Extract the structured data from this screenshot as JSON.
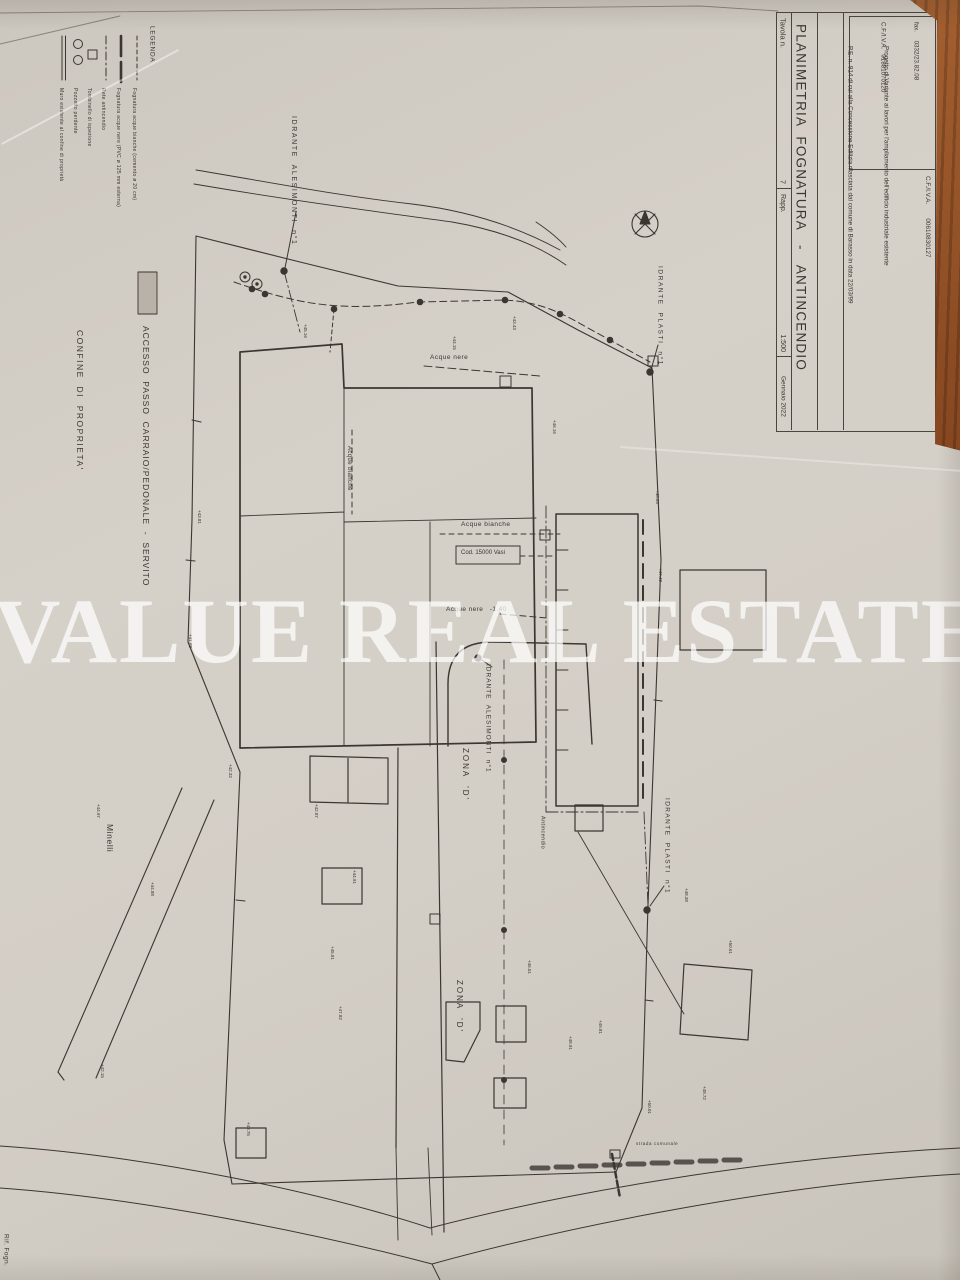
{
  "colors": {
    "paper": "#d3cec6",
    "ink": "#3b3631",
    "wood": "#8a4a22",
    "watermark": "rgba(255,255,255,0.72)",
    "access_swatch": "#b8b2a8"
  },
  "watermark": "VALUE REAL ESTATE",
  "title_block": {
    "tavola_label": "Tavola n.",
    "tavola_number": "7",
    "title": "PLANIMETRIA  FOGNATURA   -   ANTINCENDIO",
    "scale_label": "Rapp.",
    "scale_value": "1:500",
    "date": "Gennaio 2022",
    "project_line1": "Progetto di Variante ai lavori per l'ampliamento dell'edificio industriale esistente",
    "project_line2": "P.E. n. 914 di cui alla Concessione Edilizia rilasciata dal comune di Barasso in data 22/03/99",
    "engineer": {
      "name": "Ing.  Giuseppe  Ambrosetti",
      "address": "via  Robbioni  N. 17  Varese",
      "tel": "tel.      0332/28.51.85",
      "fax": "fax.     0332/23.82.08",
      "cf": "C.F./I.V.A.   01881070120"
    },
    "client": {
      "line1": "Committ.:  Ditta MONTI & C.   con sede in BARASSO",
      "line2": "BARASSO (Va) via Oltrona  n.  28.",
      "line3": "C.F./I.V.A.        00610830127"
    }
  },
  "legend": {
    "title": "LEGENDA",
    "items": [
      {
        "label": "Fognatura acque bianche (cemento ø 20 cm)",
        "x": 134
      },
      {
        "label": "Fognatura acque nere (PVC ø 125 mm esterna)",
        "x": 118
      },
      {
        "label": "Rete antincendio",
        "x": 103
      },
      {
        "label": "Tombinello di ispezione",
        "x": 89
      },
      {
        "label": "Pozzetto perdente",
        "x": 75
      },
      {
        "label": "Muro esistente al confine di proprietà",
        "x": 61
      }
    ],
    "access_label": "ACCESSO  PASSO  CARRAIO/PEDONALE  -  SERVITO",
    "boundary_label": "CONFINE  DI  PROPRIETA'"
  },
  "plan_labels": [
    {
      "name": "label-idrante-alesimonti-1",
      "text": "IDRANTE  ALESIMONTI  n°1",
      "x": 289,
      "y": 116,
      "w": 190,
      "fs": 7,
      "ls": 1.6,
      "o": "v"
    },
    {
      "name": "label-idrante-plasti-1",
      "text": "IDRANTE  PLASTI  n°1",
      "x": 656,
      "y": 266,
      "w": 150,
      "fs": 6.5,
      "ls": 1.6,
      "o": "v"
    },
    {
      "name": "label-idrante-alesimonti-2",
      "text": "IDRANTE  ALESIMONTI  n°1",
      "x": 484,
      "y": 664,
      "w": 165,
      "fs": 6.5,
      "ls": 1,
      "o": "v"
    },
    {
      "name": "label-idrante-plasti-2",
      "text": "IDRANTE  PLASTI  n°1",
      "x": 663,
      "y": 798,
      "w": 145,
      "fs": 6.5,
      "ls": 1.4,
      "o": "v"
    },
    {
      "name": "label-acque-nere-top",
      "text": "Acque nere",
      "x": 430,
      "y": 354,
      "w": 70,
      "fs": 6.5,
      "ls": 0.5,
      "o": "h"
    },
    {
      "name": "label-acque-bianche-vert",
      "text": "Acque bianche",
      "x": 345,
      "y": 446,
      "w": 80,
      "fs": 6,
      "ls": 0.4,
      "o": "v"
    },
    {
      "name": "label-acque-bianche-horiz",
      "text": "Acque bianche",
      "x": 461,
      "y": 521,
      "w": 84,
      "fs": 6.5,
      "ls": 0.5,
      "o": "h"
    },
    {
      "name": "label-cod-vasi",
      "text": "Cod. 15000 Vasi",
      "x": 461,
      "y": 550,
      "w": 58,
      "fs": 6,
      "ls": 0,
      "o": "h"
    },
    {
      "name": "label-acque-nere-quota",
      "text": "Acque nere   -1.40",
      "x": 446,
      "y": 606,
      "w": 110,
      "fs": 6.5,
      "ls": 0.4,
      "o": "h"
    },
    {
      "name": "label-zona-d-1",
      "text": "ZONA  'D'",
      "x": 461,
      "y": 748,
      "w": 64,
      "fs": 8,
      "ls": 2,
      "o": "v"
    },
    {
      "name": "label-zona-d-2",
      "text": "ZONA  'D'",
      "x": 455,
      "y": 980,
      "w": 64,
      "fs": 8,
      "ls": 2,
      "o": "v"
    },
    {
      "name": "label-minelli",
      "text": "Minelli",
      "x": 104,
      "y": 824,
      "w": 48,
      "fs": 8.5,
      "ls": 0.6,
      "o": "v"
    },
    {
      "name": "label-antincendio",
      "text": "Antincendio",
      "x": 539,
      "y": 816,
      "w": 66,
      "fs": 5.5,
      "ls": 0.4,
      "o": "v"
    },
    {
      "name": "label-strada-comunale",
      "text": "strada comunale",
      "x": 636,
      "y": 1141,
      "w": 70,
      "fs": 4.5,
      "ls": 0.6,
      "o": "h"
    },
    {
      "name": "label-rif-fognatura",
      "text": "Rif. Fogn.",
      "x": 2,
      "y": 1234,
      "w": 46,
      "fs": 6.5,
      "ls": 0.4,
      "o": "v"
    }
  ],
  "elevation_marks": [
    {
      "v": "+45.16",
      "x": 303,
      "y": 324
    },
    {
      "v": "+44.15",
      "x": 452,
      "y": 336
    },
    {
      "v": "+43.43",
      "x": 512,
      "y": 316
    },
    {
      "v": "+46.16",
      "x": 552,
      "y": 420
    },
    {
      "v": "+48.65",
      "x": 655,
      "y": 490
    },
    {
      "v": "+47.48",
      "x": 658,
      "y": 568
    },
    {
      "v": "+43.81",
      "x": 197,
      "y": 510
    },
    {
      "v": "+41.88",
      "x": 188,
      "y": 634
    },
    {
      "v": "+42.32",
      "x": 228,
      "y": 764
    },
    {
      "v": "+42.87",
      "x": 314,
      "y": 804
    },
    {
      "v": "+44.91",
      "x": 352,
      "y": 870
    },
    {
      "v": "+45.81",
      "x": 330,
      "y": 946
    },
    {
      "v": "+47.82",
      "x": 338,
      "y": 1006
    },
    {
      "v": "+43.75",
      "x": 246,
      "y": 1122
    },
    {
      "v": "+42.15",
      "x": 100,
      "y": 1064
    },
    {
      "v": "+44.97",
      "x": 96,
      "y": 804
    },
    {
      "v": "+44.88",
      "x": 150,
      "y": 882
    },
    {
      "v": "+48.38",
      "x": 684,
      "y": 888
    },
    {
      "v": "+50.61",
      "x": 728,
      "y": 940
    },
    {
      "v": "+48.72",
      "x": 702,
      "y": 1086
    },
    {
      "v": "+50.01",
      "x": 647,
      "y": 1100
    },
    {
      "v": "+49.81",
      "x": 598,
      "y": 1020
    },
    {
      "v": "+46.51",
      "x": 527,
      "y": 960
    },
    {
      "v": "+48.91",
      "x": 568,
      "y": 1036
    }
  ]
}
